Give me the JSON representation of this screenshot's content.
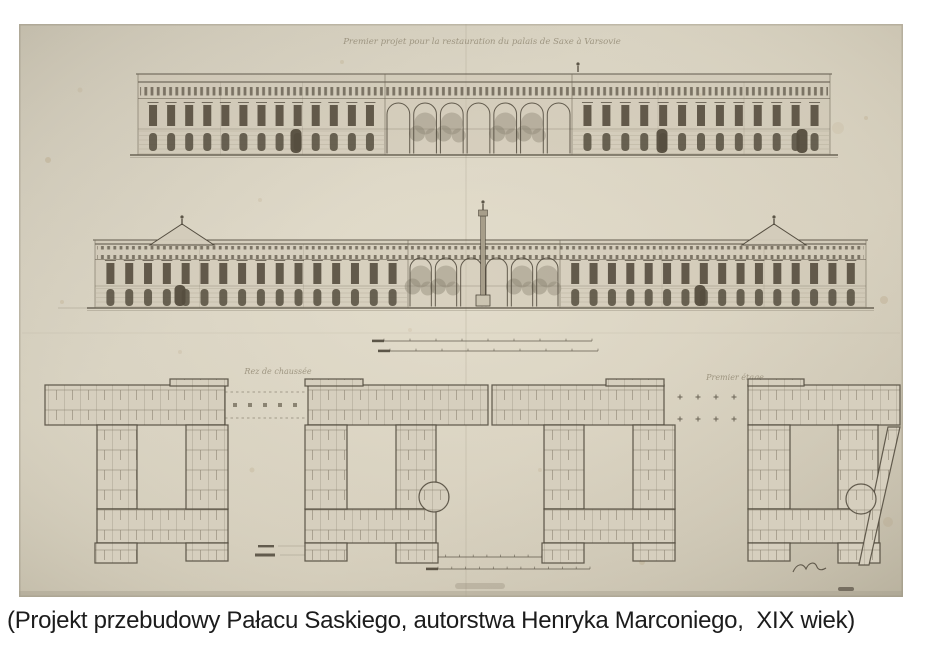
{
  "caption": "(Projekt przebudowy Pałacu Saskiego, autorstwa Henryka Marconiego,  XIX wiek)",
  "drawing": {
    "title_inscription": "Premier projet pour la restauration du palais de Saxe à Varsovie",
    "plan_ground_label": "Rez de chaussée",
    "plan_first_label": "Premier étage",
    "colors": {
      "background": "#ffffff",
      "paper": "#d3ccbb",
      "paper_edge": "#c2bbaa",
      "face": "#cbc4b1",
      "ink": "#6f6757",
      "ink_dark": "#4e473a",
      "window": "#554d3e",
      "foliage": "#8a8270",
      "stain": "#a98f63",
      "inscription_ink": "#8f8671",
      "caption_text": "#1c1c1c"
    }
  }
}
